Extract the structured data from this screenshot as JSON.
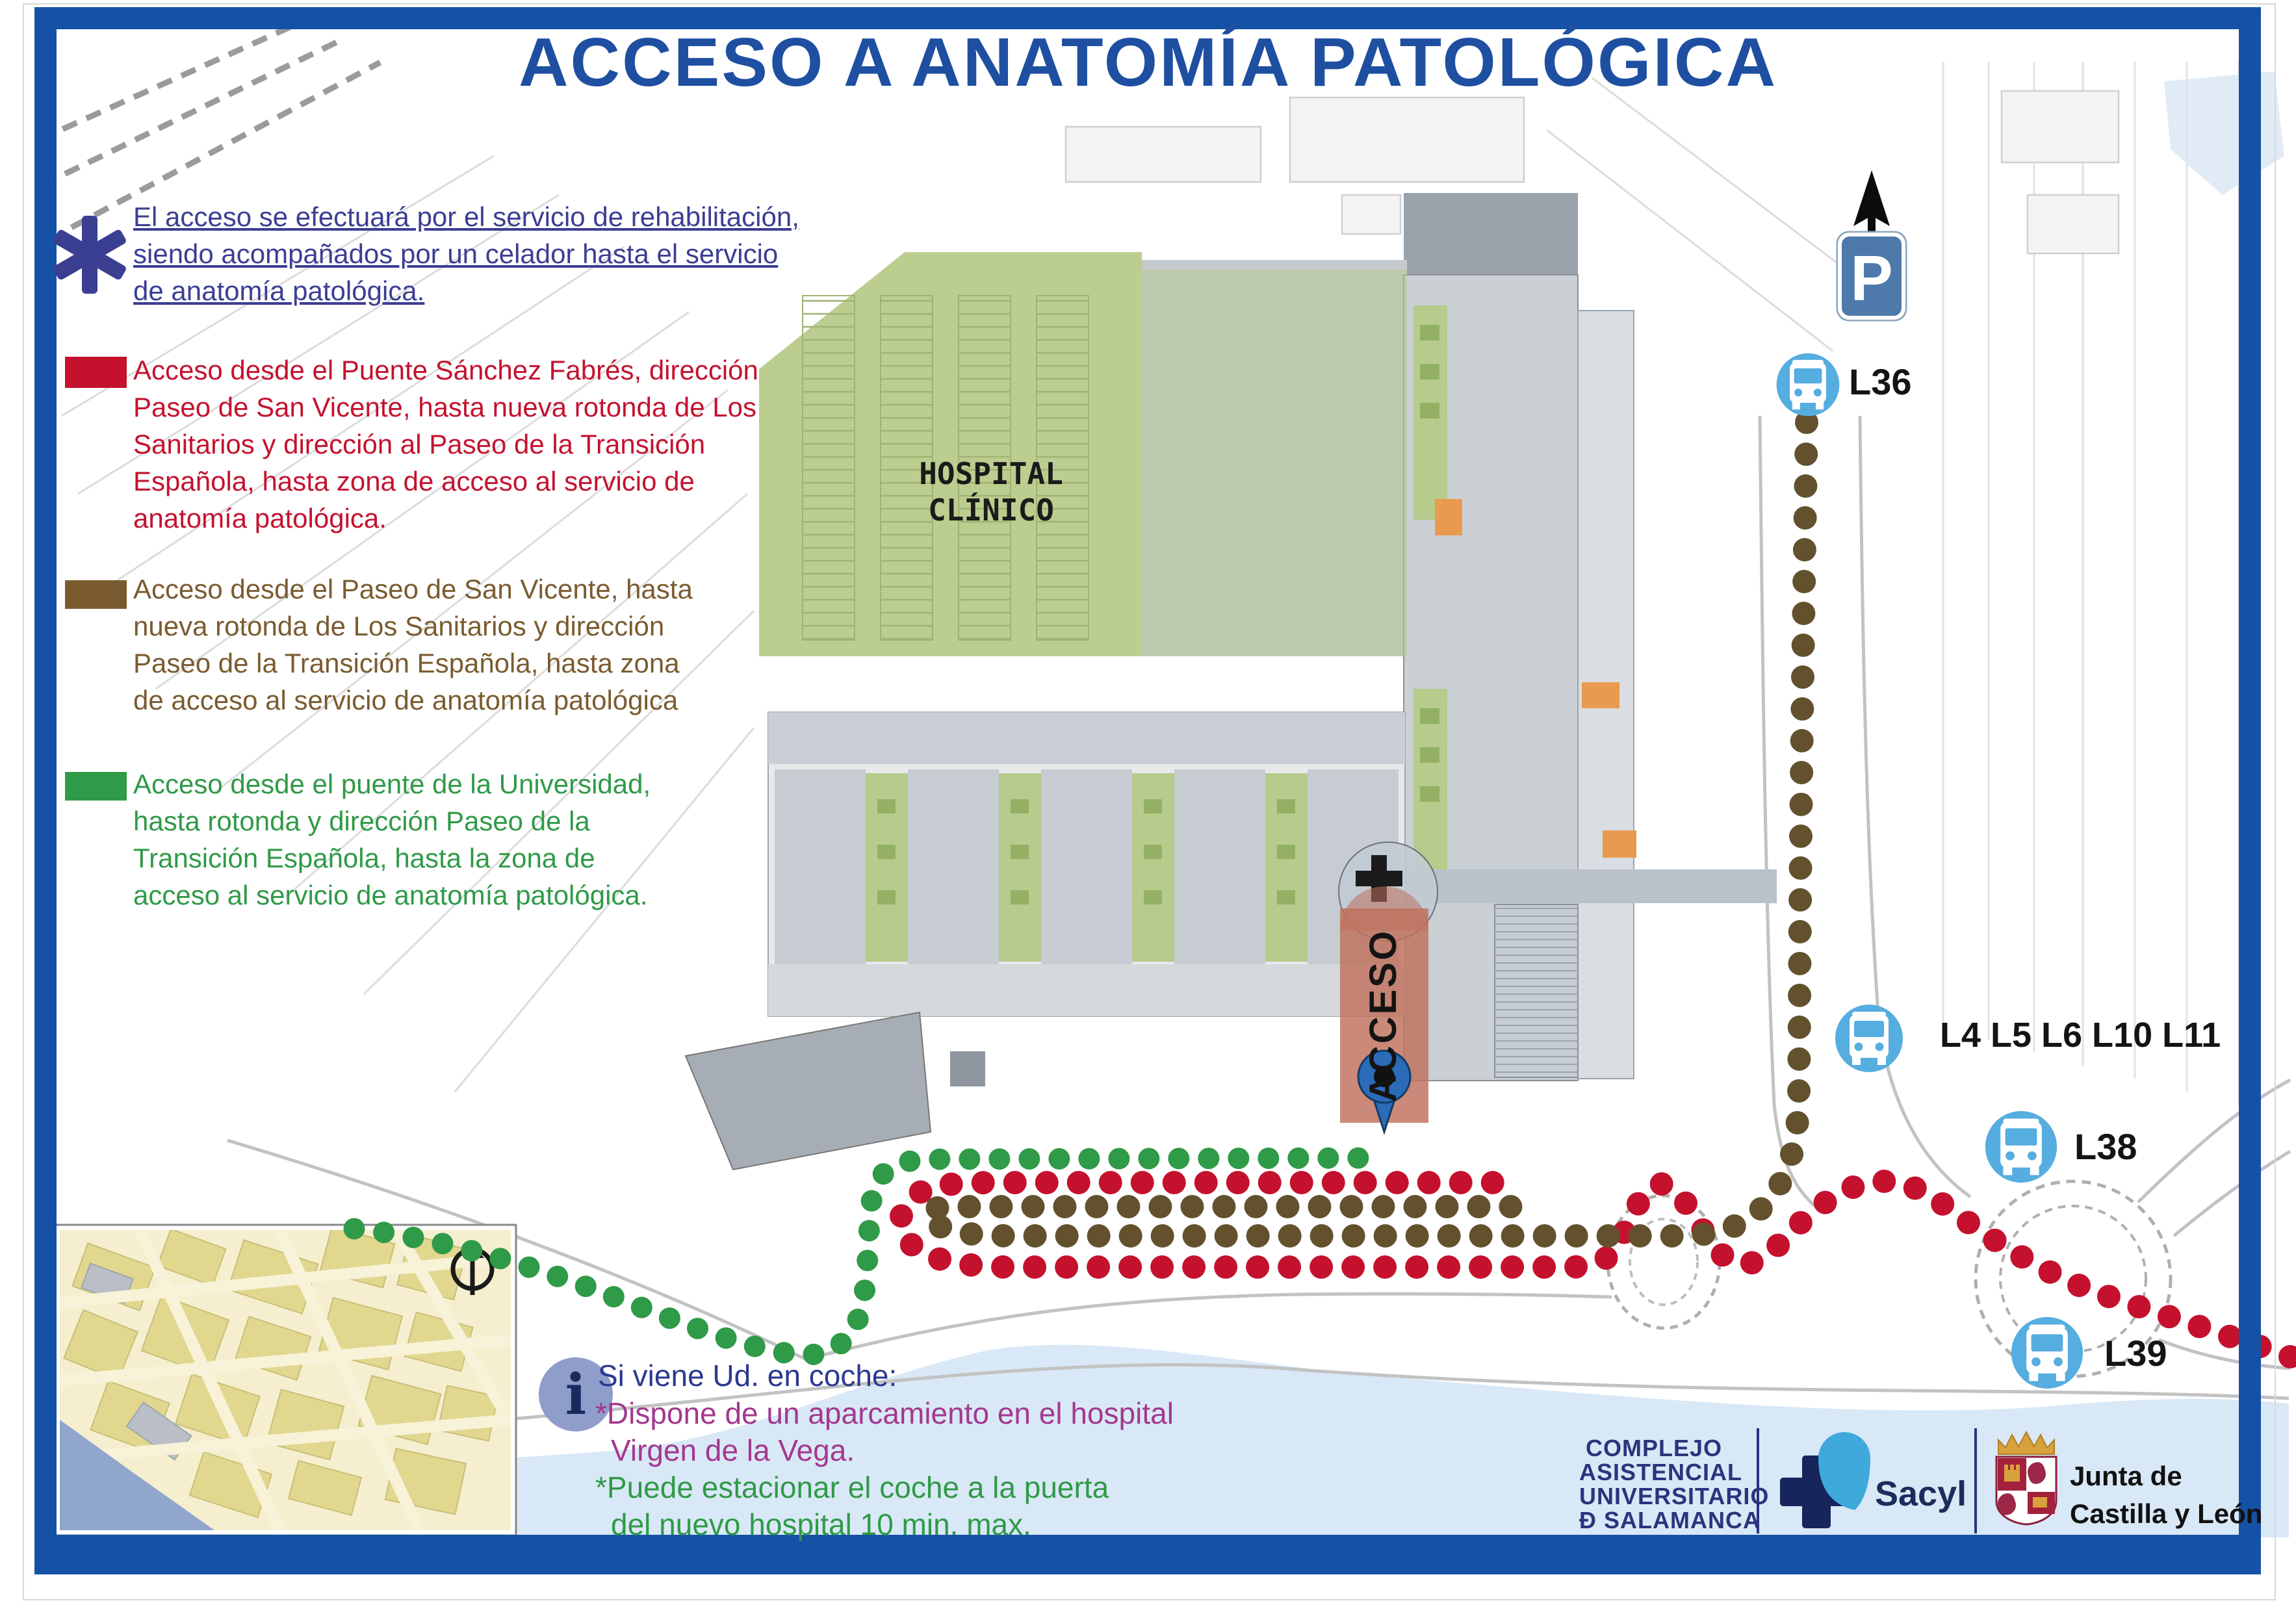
{
  "title": "ACCESO A ANATOMÍA PATOLÓGICA",
  "note": {
    "lines": [
      "El acceso se efectuará por el servicio de rehabilitación,",
      "siendo acompañados por un celador hasta el servicio",
      "de anatomía patológica."
    ]
  },
  "legend": {
    "items": [
      {
        "id": "red-route",
        "color": "#C4122E",
        "lines": [
          "Acceso desde el Puente Sánchez Fabrés, dirección",
          "Paseo de San Vicente, hasta nueva rotonda de Los",
          "Sanitarios y dirección al Paseo de la Transición",
          "Española, hasta zona de acceso al servicio de",
          "anatomía patológica."
        ]
      },
      {
        "id": "brown-route",
        "color": "#7A5B2F",
        "lines": [
          "Acceso desde el Paseo de San Vicente, hasta",
          "nueva rotonda de Los Sanitarios y dirección",
          "Paseo de la Transición Española, hasta zona",
          "de acceso al servicio de anatomía patológica"
        ]
      },
      {
        "id": "green-route",
        "color": "#2F9A47",
        "lines": [
          "Acceso desde el puente de la Universidad,",
          "hasta rotonda y dirección Paseo de la",
          "Transición Española, hasta la zona de",
          "acceso al servicio de anatomía patológica."
        ]
      }
    ]
  },
  "map": {
    "hospital_label_lines": [
      "HOSPITAL",
      "CLÍNICO"
    ],
    "acceso_label": "ACCESO",
    "parking_sign": "P",
    "bus_stops": [
      {
        "icon": "bus-icon",
        "label": "L36"
      },
      {
        "icon": "bus-icon",
        "label": "L4 L5 L6 L10 L11"
      },
      {
        "icon": "bus-icon",
        "label": "L38"
      },
      {
        "icon": "bus-icon",
        "label": "L39"
      }
    ],
    "route_colors": {
      "red": "#C4122E",
      "brown": "#63512E",
      "green": "#2F9A47"
    },
    "water_color": "#D9E8F6",
    "parking_area_color": "#BCCE8F",
    "access_zone_color": "#C0705C",
    "pin_color": "#2B6CB8",
    "bus_circle_color": "#56ADE0",
    "frame_color": "#1552A5",
    "title_color": "#1E4FA1"
  },
  "info": {
    "icon": "i",
    "heading": "Si viene Ud. en coche:",
    "lines": [
      {
        "text": "*Dispone de un aparcamiento en el hospital",
        "color": "#A3388F"
      },
      {
        "text": "Virgen de la Vega.",
        "color": "#A3388F"
      },
      {
        "text": "*Puede estacionar el coche a la puerta",
        "color": "#2F9A47"
      },
      {
        "text": "del nuevo hospital 10 min. max.",
        "color": "#2F9A47"
      }
    ]
  },
  "footer": {
    "complejo_lines": [
      "COMPLEJO",
      "ASISTENCIAL",
      "UNIVERSITARIO",
      "Ð SALAMANCA"
    ],
    "sacyl": "Sacyl",
    "junta_lines": [
      "Junta de",
      "Castilla y León"
    ]
  }
}
